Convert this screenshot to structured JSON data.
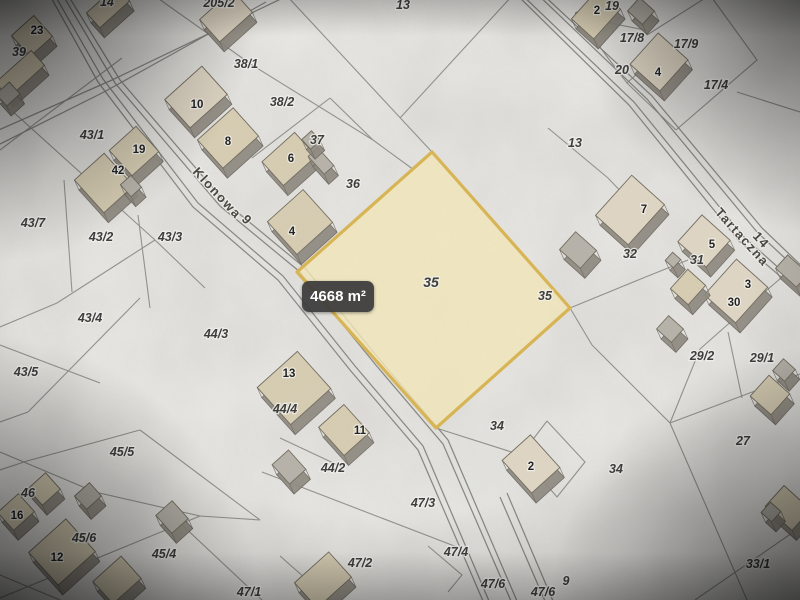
{
  "map": {
    "area_badge": {
      "text": "4668 m²"
    },
    "highlighted_parcel": {
      "label": "35",
      "area_text": "4668 m²",
      "fill": "rgba(241,230,183,0.82)",
      "border": "#d9b44e",
      "points": [
        [
          432,
          152
        ],
        [
          570,
          308
        ],
        [
          436,
          428
        ],
        [
          297,
          272
        ]
      ]
    },
    "colors": {
      "bg": "#e9e8e4",
      "line": "#90908c",
      "road": "#878783",
      "roof": "#d6ccb1",
      "roof_light": "#ded5c2",
      "shed": "#b6b2a9",
      "wall": "#8e897f",
      "wall_edge": "#6b665e",
      "roof_edge": "#726c5d",
      "parcel_text": "#3b3b3b",
      "building_text": "#1f1f1f",
      "street_text": "#46463f",
      "halo": "rgba(244,243,238,0.8)"
    },
    "streets": [
      {
        "name": "Klonowa",
        "number": "9"
      },
      {
        "name": "Tartaczna",
        "number": "14"
      }
    ],
    "labels": [
      {
        "t": "Klonowa",
        "x": 214,
        "y": 196,
        "k": "s",
        "rot": 47
      },
      {
        "t": "9",
        "x": 244,
        "y": 223,
        "k": "s",
        "rot": 47
      },
      {
        "t": "Tartaczna",
        "x": 739,
        "y": 240,
        "k": "s",
        "rot": 48
      },
      {
        "t": "14",
        "x": 758,
        "y": 243,
        "k": "s",
        "rot": 48
      },
      {
        "t": "14",
        "x": 107,
        "y": 6,
        "k": "p"
      },
      {
        "t": "205/2",
        "x": 219,
        "y": 7,
        "k": "p"
      },
      {
        "t": "13",
        "x": 403,
        "y": 9,
        "k": "p"
      },
      {
        "t": "19",
        "x": 612,
        "y": 10,
        "k": "p"
      },
      {
        "t": "39",
        "x": 19,
        "y": 56,
        "k": "p"
      },
      {
        "t": "38/1",
        "x": 246,
        "y": 68,
        "k": "p"
      },
      {
        "t": "38/2",
        "x": 282,
        "y": 106,
        "k": "p"
      },
      {
        "t": "17/8",
        "x": 632,
        "y": 42,
        "k": "p"
      },
      {
        "t": "17/9",
        "x": 686,
        "y": 48,
        "k": "p"
      },
      {
        "t": "20",
        "x": 622,
        "y": 74,
        "k": "p"
      },
      {
        "t": "17/4",
        "x": 716,
        "y": 89,
        "k": "p"
      },
      {
        "t": "43/1",
        "x": 92,
        "y": 139,
        "k": "p"
      },
      {
        "t": "37",
        "x": 317,
        "y": 144,
        "k": "p"
      },
      {
        "t": "36",
        "x": 353,
        "y": 188,
        "k": "p"
      },
      {
        "t": "13",
        "x": 575,
        "y": 147,
        "k": "p"
      },
      {
        "t": "43/7",
        "x": 33,
        "y": 227,
        "k": "p"
      },
      {
        "t": "43/2",
        "x": 101,
        "y": 241,
        "k": "p"
      },
      {
        "t": "43/3",
        "x": 170,
        "y": 241,
        "k": "p"
      },
      {
        "t": "35",
        "x": 431,
        "y": 287,
        "k": "p",
        "sz": 14
      },
      {
        "t": "35",
        "x": 545,
        "y": 300,
        "k": "p"
      },
      {
        "t": "32",
        "x": 630,
        "y": 258,
        "k": "p"
      },
      {
        "t": "31",
        "x": 697,
        "y": 264,
        "k": "p"
      },
      {
        "t": "29/2",
        "x": 702,
        "y": 360,
        "k": "p"
      },
      {
        "t": "29/1",
        "x": 762,
        "y": 362,
        "k": "p"
      },
      {
        "t": "27",
        "x": 743,
        "y": 445,
        "k": "p"
      },
      {
        "t": "34",
        "x": 497,
        "y": 430,
        "k": "p"
      },
      {
        "t": "34",
        "x": 616,
        "y": 473,
        "k": "p"
      },
      {
        "t": "33/1",
        "x": 758,
        "y": 568,
        "k": "p"
      },
      {
        "t": "43/4",
        "x": 90,
        "y": 322,
        "k": "p"
      },
      {
        "t": "44/3",
        "x": 216,
        "y": 338,
        "k": "p"
      },
      {
        "t": "43/5",
        "x": 26,
        "y": 376,
        "k": "p"
      },
      {
        "t": "44/4",
        "x": 285,
        "y": 413,
        "k": "p"
      },
      {
        "t": "45/5",
        "x": 122,
        "y": 456,
        "k": "p"
      },
      {
        "t": "44/2",
        "x": 333,
        "y": 472,
        "k": "p"
      },
      {
        "t": "46",
        "x": 28,
        "y": 497,
        "k": "p"
      },
      {
        "t": "45/6",
        "x": 84,
        "y": 542,
        "k": "p"
      },
      {
        "t": "45/4",
        "x": 164,
        "y": 558,
        "k": "p"
      },
      {
        "t": "47/2",
        "x": 360,
        "y": 567,
        "k": "p"
      },
      {
        "t": "47/1",
        "x": 249,
        "y": 596,
        "k": "p"
      },
      {
        "t": "47/3",
        "x": 423,
        "y": 507,
        "k": "p"
      },
      {
        "t": "47/4",
        "x": 456,
        "y": 556,
        "k": "p"
      },
      {
        "t": "47/6",
        "x": 493,
        "y": 588,
        "k": "p"
      },
      {
        "t": "47/6",
        "x": 543,
        "y": 596,
        "k": "p"
      },
      {
        "t": "9",
        "x": 566,
        "y": 585,
        "k": "p"
      },
      {
        "t": "23",
        "x": 37,
        "y": 34,
        "k": "b"
      },
      {
        "t": "10",
        "x": 197,
        "y": 108,
        "k": "b"
      },
      {
        "t": "8",
        "x": 228,
        "y": 145,
        "k": "b"
      },
      {
        "t": "19",
        "x": 139,
        "y": 153,
        "k": "b"
      },
      {
        "t": "42",
        "x": 118,
        "y": 174,
        "k": "b"
      },
      {
        "t": "6",
        "x": 291,
        "y": 162,
        "k": "b"
      },
      {
        "t": "4",
        "x": 292,
        "y": 235,
        "k": "b"
      },
      {
        "t": "2",
        "x": 597,
        "y": 14,
        "k": "b"
      },
      {
        "t": "4",
        "x": 658,
        "y": 76,
        "k": "b"
      },
      {
        "t": "7",
        "x": 644,
        "y": 213,
        "k": "b"
      },
      {
        "t": "5",
        "x": 712,
        "y": 248,
        "k": "b"
      },
      {
        "t": "3",
        "x": 748,
        "y": 288,
        "k": "b"
      },
      {
        "t": "30",
        "x": 734,
        "y": 306,
        "k": "b"
      },
      {
        "t": "13",
        "x": 289,
        "y": 377,
        "k": "b"
      },
      {
        "t": "11",
        "x": 360,
        "y": 434,
        "k": "b"
      },
      {
        "t": "2",
        "x": 531,
        "y": 470,
        "k": "b"
      },
      {
        "t": "12",
        "x": 57,
        "y": 561,
        "k": "b"
      },
      {
        "t": "16",
        "x": 17,
        "y": 519,
        "k": "b"
      }
    ],
    "buildings": [
      [
        108,
        7,
        40,
        20,
        -42,
        0
      ],
      [
        226,
        16,
        44,
        30,
        -42,
        1
      ],
      [
        32,
        36,
        30,
        28,
        -42,
        0
      ],
      [
        20,
        74,
        48,
        20,
        -42,
        0
      ],
      [
        8,
        94,
        18,
        16,
        -42,
        2
      ],
      [
        196,
        97,
        50,
        38,
        -42,
        1
      ],
      [
        228,
        138,
        48,
        38,
        -42,
        0
      ],
      [
        134,
        151,
        36,
        34,
        -42,
        0
      ],
      [
        104,
        183,
        40,
        44,
        -42,
        0
      ],
      [
        131,
        186,
        14,
        16,
        -42,
        2
      ],
      [
        289,
        159,
        44,
        32,
        -42,
        0
      ],
      [
        321,
        161,
        13,
        24,
        -42,
        2
      ],
      [
        311,
        140,
        13,
        13,
        -42,
        2
      ],
      [
        300,
        222,
        48,
        44,
        -42,
        0
      ],
      [
        596,
        14,
        40,
        30,
        -48,
        0
      ],
      [
        641,
        11,
        18,
        20,
        -48,
        2
      ],
      [
        659,
        62,
        42,
        40,
        -48,
        1
      ],
      [
        630,
        210,
        54,
        44,
        -48,
        1
      ],
      [
        578,
        250,
        24,
        28,
        -48,
        2
      ],
      [
        704,
        241,
        36,
        38,
        -48,
        1
      ],
      [
        673,
        260,
        11,
        11,
        -48,
        2
      ],
      [
        736,
        291,
        48,
        42,
        -48,
        1
      ],
      [
        688,
        287,
        26,
        24,
        -48,
        0
      ],
      [
        670,
        329,
        18,
        20,
        -48,
        2
      ],
      [
        792,
        271,
        18,
        28,
        -48,
        2
      ],
      [
        294,
        388,
        54,
        50,
        -42,
        0
      ],
      [
        289,
        467,
        22,
        26,
        -42,
        2
      ],
      [
        344,
        430,
        34,
        38,
        -42,
        0
      ],
      [
        531,
        464,
        38,
        44,
        -42,
        1
      ],
      [
        44,
        489,
        24,
        22,
        -42,
        0
      ],
      [
        16,
        512,
        28,
        24,
        -42,
        0
      ],
      [
        62,
        552,
        50,
        44,
        -42,
        0
      ],
      [
        88,
        496,
        20,
        18,
        -42,
        2
      ],
      [
        172,
        517,
        22,
        24,
        -42,
        2
      ],
      [
        117,
        580,
        38,
        30,
        -42,
        0
      ],
      [
        323,
        580,
        46,
        34,
        -42,
        0
      ],
      [
        770,
        395,
        28,
        28,
        -48,
        0
      ],
      [
        784,
        370,
        16,
        16,
        -48,
        2
      ],
      [
        788,
        508,
        28,
        36,
        -48,
        0
      ],
      [
        771,
        512,
        14,
        14,
        -48,
        2
      ]
    ],
    "roads": [
      [
        [
          66,
          -8
        ],
        [
          120,
          80
        ],
        [
          225,
          202
        ],
        [
          305,
          268
        ],
        [
          380,
          360
        ],
        [
          448,
          440
        ],
        [
          520,
          608
        ]
      ],
      [
        [
          61,
          -8
        ],
        [
          115,
          83
        ],
        [
          220,
          206
        ],
        [
          300,
          272
        ],
        [
          375,
          364
        ],
        [
          443,
          444
        ],
        [
          514,
          608
        ]
      ],
      [
        [
          48,
          -8
        ],
        [
          98,
          82
        ],
        [
          193,
          207
        ],
        [
          278,
          280
        ],
        [
          350,
          370
        ],
        [
          418,
          450
        ],
        [
          486,
          608
        ]
      ],
      [
        [
          53,
          -8
        ],
        [
          103,
          79
        ],
        [
          198,
          203
        ],
        [
          283,
          276
        ],
        [
          355,
          366
        ],
        [
          423,
          446
        ],
        [
          492,
          608
        ]
      ],
      [
        [
          287,
          -4
        ],
        [
          112,
          80
        ],
        [
          -8,
          133
        ]
      ],
      [
        [
          266,
          2
        ],
        [
          104,
          92
        ],
        [
          -8,
          148
        ]
      ],
      [
        [
          540,
          -8
        ],
        [
          652,
          96
        ],
        [
          762,
          228
        ],
        [
          808,
          272
        ]
      ],
      [
        [
          535,
          -8
        ],
        [
          647,
          99
        ],
        [
          757,
          232
        ],
        [
          804,
          276
        ]
      ],
      [
        [
          514,
          -8
        ],
        [
          629,
          105
        ],
        [
          739,
          241
        ],
        [
          808,
          300
        ]
      ],
      [
        [
          519,
          -8
        ],
        [
          634,
          102
        ],
        [
          744,
          237
        ],
        [
          808,
          294
        ]
      ],
      [
        [
          500,
          497
        ],
        [
          548,
          608
        ]
      ],
      [
        [
          507,
          493
        ],
        [
          556,
          608
        ]
      ]
    ],
    "boundaries": [
      [
        [
          0,
          150
        ],
        [
          122,
          58
        ]
      ],
      [
        [
          0,
          100
        ],
        [
          155,
          240
        ]
      ],
      [
        [
          155,
          240
        ],
        [
          57,
          303
        ],
        [
          0,
          327
        ]
      ],
      [
        [
          64,
          180
        ],
        [
          72,
          292
        ]
      ],
      [
        [
          138,
          215
        ],
        [
          150,
          308
        ]
      ],
      [
        [
          155,
          240
        ],
        [
          205,
          288
        ]
      ],
      [
        [
          0,
          345
        ],
        [
          100,
          383
        ]
      ],
      [
        [
          140,
          298
        ],
        [
          28,
          412
        ]
      ],
      [
        [
          28,
          412
        ],
        [
          0,
          422
        ]
      ],
      [
        [
          140,
          430
        ],
        [
          27,
          461
        ],
        [
          0,
          470
        ]
      ],
      [
        [
          140,
          430
        ],
        [
          260,
          520
        ]
      ],
      [
        [
          0,
          598
        ],
        [
          200,
          516
        ],
        [
          260,
          520
        ]
      ],
      [
        [
          0,
          452
        ],
        [
          95,
          492
        ],
        [
          200,
          516
        ]
      ],
      [
        [
          436,
          428
        ],
        [
          521,
          455
        ]
      ],
      [
        [
          547,
          421
        ],
        [
          585,
          462
        ],
        [
          557,
          497
        ],
        [
          521,
          455
        ],
        [
          547,
          421
        ]
      ],
      [
        [
          262,
          472
        ],
        [
          457,
          547
        ]
      ],
      [
        [
          280,
          438
        ],
        [
          344,
          468
        ]
      ],
      [
        [
          428,
          546
        ],
        [
          462,
          575
        ],
        [
          448,
          592
        ]
      ],
      [
        [
          180,
          523
        ],
        [
          262,
          600
        ]
      ],
      [
        [
          280,
          556
        ],
        [
          330,
          600
        ]
      ],
      [
        [
          592,
          345
        ],
        [
          670,
          423
        ],
        [
          747,
          600
        ]
      ],
      [
        [
          670,
          423
        ],
        [
          800,
          374
        ]
      ],
      [
        [
          570,
          308
        ],
        [
          592,
          345
        ]
      ],
      [
        [
          570,
          308
        ],
        [
          648,
          276
        ],
        [
          688,
          260
        ]
      ],
      [
        [
          700,
          349
        ],
        [
          670,
          423
        ]
      ],
      [
        [
          700,
          349
        ],
        [
          760,
          296
        ],
        [
          788,
          272
        ]
      ],
      [
        [
          728,
          332
        ],
        [
          742,
          398
        ]
      ],
      [
        [
          695,
          600
        ],
        [
          808,
          522
        ]
      ],
      [
        [
          548,
          128
        ],
        [
          608,
          178
        ],
        [
          650,
          222
        ]
      ],
      [
        [
          287,
          -4
        ],
        [
          432,
          152
        ]
      ],
      [
        [
          400,
          118
        ],
        [
          512,
          -4
        ]
      ],
      [
        [
          252,
          65
        ],
        [
          373,
          140
        ],
        [
          414,
          170
        ]
      ],
      [
        [
          152,
          -6
        ],
        [
          252,
          65
        ]
      ],
      [
        [
          575,
          13
        ],
        [
          618,
          -6
        ]
      ],
      [
        [
          575,
          13
        ],
        [
          608,
          58
        ],
        [
          627,
          83
        ],
        [
          650,
          62
        ]
      ],
      [
        [
          595,
          20
        ],
        [
          650,
          31
        ]
      ],
      [
        [
          627,
          83
        ],
        [
          676,
          130
        ]
      ],
      [
        [
          647,
          35
        ],
        [
          710,
          -5
        ]
      ],
      [
        [
          710,
          -5
        ],
        [
          757,
          60
        ],
        [
          676,
          130
        ]
      ],
      [
        [
          737,
          92
        ],
        [
          800,
          112
        ]
      ],
      [
        [
          252,
          158
        ],
        [
          330,
          98
        ]
      ],
      [
        [
          330,
          98
        ],
        [
          373,
          140
        ]
      ],
      [
        [
          0,
          575
        ],
        [
          60,
          600
        ]
      ]
    ]
  }
}
